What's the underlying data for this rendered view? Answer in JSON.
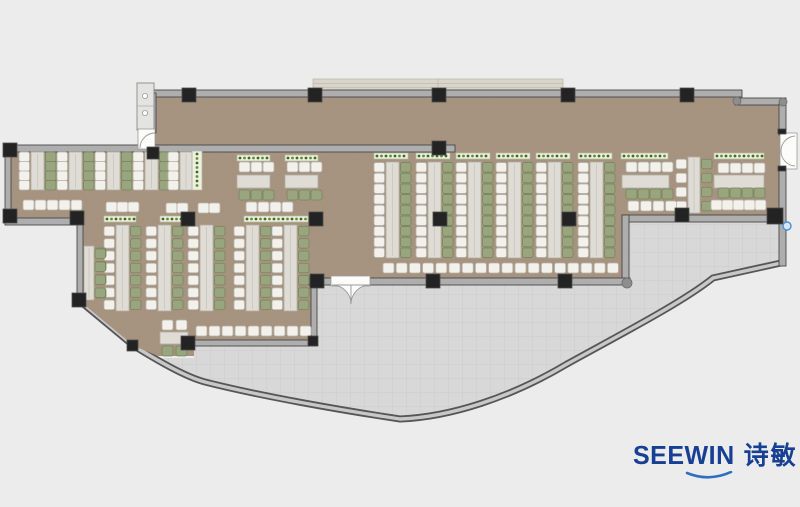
{
  "logo": {
    "wordmark": "SEEWIN",
    "chinese": "诗敏",
    "color": "#173f93",
    "swoosh_color": "#2d6fc0"
  },
  "plan": {
    "colors": {
      "bg": "#ececec",
      "floor": "#a89480",
      "grainTint": "#4a3c2c",
      "terrace": "#d8d8d8",
      "tileLine": "#c9c9c9",
      "wall": "#aeaeae",
      "wallEdge": "#474747",
      "wallDark": "#565656",
      "wallLight": "#c8c8c8",
      "column": "#232323",
      "columnEdge": "#4d4d4d",
      "desk": "#dfdcd5",
      "deskEdge": "#b1ada3",
      "chairW": "#f3f1ec",
      "chairWs": "#b9b5ac",
      "chairG": "#99a57e",
      "chairGs": "#77865c",
      "planter": "#edefe1",
      "planterEdge": "#b5bba2",
      "dotA": "#5f9030",
      "dotB": "#3f6b1f",
      "plank": "#d9d5ca",
      "plankLine": "#bcb8ad",
      "doorFill": "#fcfcfb",
      "doorLine": "#9a9a9a",
      "fixture": "#e3e3df",
      "node": "#8e8e8e",
      "blueNode": "#4a8fd4"
    },
    "floorPath": "M 153,95 L 740,95 L 740,104 L 783,104 L 783,218 L 625,218 L 625,281 L 314,281 L 314,343 L 194,343 L 194,356 L 158,356 L 134,346 L 81,302 L 81,222 L 8,222 L 8,149 L 150,149 L 150,95 Z",
    "terracePath": "M 314,284 L 625,284 L 625,221 L 783,221 L 783,262 L 713,278 C 683,302 625,332 567,364 C 510,398 450,417 400,419 C 340,410 260,396 205,382 C 186,377 160,362 137,349 L 158,358 L 194,358 L 194,345 L 314,345 Z",
    "curveWallPath": "M 81,302 L 134,346 C 160,362 186,377 205,382 C 260,396 340,410 400,419 C 450,417 510,398 567,364 C 625,332 683,302 713,278 L 781,263",
    "plank": [
      313,
      79,
      250,
      13
    ],
    "walls": [
      [
        153,
        90,
        589,
        7
      ],
      [
        735,
        98,
        51,
        7
      ],
      [
        779,
        104,
        7,
        31
      ],
      [
        779,
        167,
        7,
        99
      ],
      [
        622,
        215,
        160,
        7
      ],
      [
        622,
        215,
        7,
        70
      ],
      [
        309,
        278,
        24,
        7
      ],
      [
        368,
        278,
        262,
        7
      ],
      [
        311,
        284,
        6,
        62
      ],
      [
        190,
        340,
        127,
        6
      ],
      [
        5,
        145,
        450,
        7
      ],
      [
        5,
        145,
        6,
        74
      ],
      [
        5,
        218,
        72,
        7
      ],
      [
        77,
        218,
        6,
        84
      ],
      [
        150,
        93,
        6,
        40
      ]
    ],
    "columns": [
      [
        182,
        88
      ],
      [
        308,
        88
      ],
      [
        432,
        88
      ],
      [
        561,
        88
      ],
      [
        680,
        88
      ],
      [
        432,
        141
      ],
      [
        3,
        143
      ],
      [
        3,
        209
      ],
      [
        70,
        211
      ],
      [
        72,
        293
      ],
      [
        127,
        340,
        11,
        11
      ],
      [
        147,
        147,
        12,
        12
      ],
      [
        181,
        212
      ],
      [
        309,
        212
      ],
      [
        433,
        212
      ],
      [
        562,
        212
      ],
      [
        181,
        336
      ],
      [
        308,
        336,
        10,
        10
      ],
      [
        310,
        274
      ],
      [
        426,
        274
      ],
      [
        558,
        274
      ],
      [
        675,
        208
      ],
      [
        767,
        208,
        16,
        16
      ],
      [
        778,
        129,
        8,
        5
      ],
      [
        778,
        166,
        8,
        5
      ]
    ],
    "planters": [
      [
        192,
        151,
        10,
        39
      ],
      [
        104,
        216,
        32,
        6
      ],
      [
        160,
        216,
        30,
        6
      ],
      [
        244,
        216,
        64,
        6
      ],
      [
        374,
        153,
        34,
        6
      ],
      [
        416,
        153,
        34,
        6
      ],
      [
        456,
        153,
        34,
        6
      ],
      [
        496,
        153,
        34,
        6
      ],
      [
        536,
        153,
        34,
        6
      ],
      [
        578,
        153,
        34,
        6
      ],
      [
        621,
        153,
        47,
        6
      ],
      [
        714,
        153,
        50,
        6
      ],
      [
        237,
        155,
        33,
        6
      ],
      [
        285,
        155,
        33,
        6
      ]
    ],
    "vRuns": [
      {
        "x": 31,
        "y": 152,
        "h": 38,
        "n": 4,
        "l": "w",
        "r": "g"
      },
      {
        "x": 69,
        "y": 152,
        "h": 38,
        "n": 4,
        "l": "w",
        "r": "g"
      },
      {
        "x": 107,
        "y": 152,
        "h": 38,
        "n": 4,
        "l": "w",
        "r": "g"
      },
      {
        "x": 145,
        "y": 152,
        "h": 38,
        "n": 4,
        "l": "w",
        "r": "g"
      },
      {
        "x": 180,
        "y": 152,
        "h": 38,
        "n": 4,
        "l": "w",
        "r": null,
        "w": 12
      },
      {
        "x": 116,
        "y": 225,
        "h": 86,
        "n": 7,
        "l": "w",
        "r": "g"
      },
      {
        "x": 158,
        "y": 225,
        "h": 86,
        "n": 7,
        "l": "w",
        "r": "g"
      },
      {
        "x": 200,
        "y": 225,
        "h": 86,
        "n": 7,
        "l": "w",
        "r": "g"
      },
      {
        "x": 246,
        "y": 225,
        "h": 86,
        "n": 7,
        "l": "w",
        "r": "g"
      },
      {
        "x": 284,
        "y": 225,
        "h": 86,
        "n": 7,
        "l": "w",
        "r": "g"
      },
      {
        "x": 386,
        "y": 162,
        "h": 96,
        "n": 9,
        "l": "w",
        "r": "g"
      },
      {
        "x": 428,
        "y": 162,
        "h": 96,
        "n": 9,
        "l": "w",
        "r": "g"
      },
      {
        "x": 468,
        "y": 162,
        "h": 96,
        "n": 9,
        "l": "w",
        "r": "g"
      },
      {
        "x": 508,
        "y": 162,
        "h": 96,
        "n": 9,
        "l": "w",
        "r": "g"
      },
      {
        "x": 548,
        "y": 162,
        "h": 96,
        "n": 9,
        "l": "w",
        "r": "g"
      },
      {
        "x": 590,
        "y": 162,
        "h": 96,
        "n": 9,
        "l": "w",
        "r": "g"
      },
      {
        "x": 688,
        "y": 157,
        "h": 56,
        "n": 4,
        "l": "w",
        "r": "g",
        "w": 12
      },
      {
        "x": 84,
        "y": 246,
        "h": 54,
        "n": 4,
        "l": null,
        "r": "g",
        "w": 10
      }
    ],
    "desks": [
      [
        237,
        175,
        33,
        13
      ],
      [
        285,
        175,
        33,
        13
      ],
      [
        622,
        175,
        47,
        13
      ],
      [
        714,
        175,
        50,
        13
      ],
      [
        160,
        332,
        28,
        12
      ]
    ],
    "chairRows": [
      {
        "x": 23,
        "y": 200,
        "n": 5,
        "c": "w",
        "sp": 12
      },
      {
        "x": 106,
        "y": 202,
        "n": 3,
        "c": "w",
        "sp": 11
      },
      {
        "x": 166,
        "y": 203,
        "n": 2,
        "c": "w",
        "sp": 11
      },
      {
        "x": 198,
        "y": 203,
        "n": 2,
        "c": "w",
        "sp": 11
      },
      {
        "x": 246,
        "y": 202,
        "n": 4,
        "c": "w",
        "sp": 12
      },
      {
        "x": 239,
        "y": 162,
        "n": 3,
        "c": "w",
        "sp": 12
      },
      {
        "x": 287,
        "y": 162,
        "n": 3,
        "c": "w",
        "sp": 12
      },
      {
        "x": 239,
        "y": 190,
        "n": 3,
        "c": "g",
        "sp": 12
      },
      {
        "x": 287,
        "y": 190,
        "n": 3,
        "c": "g",
        "sp": 12
      },
      {
        "x": 626,
        "y": 162,
        "n": 4,
        "c": "w",
        "sp": 12
      },
      {
        "x": 718,
        "y": 163,
        "n": 4,
        "c": "w",
        "sp": 12
      },
      {
        "x": 626,
        "y": 189,
        "n": 4,
        "c": "g",
        "sp": 12
      },
      {
        "x": 718,
        "y": 188,
        "n": 4,
        "c": "g",
        "sp": 12
      },
      {
        "x": 628,
        "y": 201,
        "n": 4,
        "c": "w",
        "sp": 12.5
      },
      {
        "x": 711,
        "y": 200,
        "n": 5,
        "c": "w",
        "sp": 11
      },
      {
        "x": 196,
        "y": 326,
        "n": 9,
        "c": "w",
        "sp": 13
      },
      {
        "x": 383,
        "y": 263,
        "n": 18,
        "c": "w",
        "sp": 13.2
      },
      {
        "x": 162,
        "y": 320,
        "n": 2,
        "c": "w",
        "sp": 14
      },
      {
        "x": 162,
        "y": 346,
        "n": 2,
        "c": "g",
        "sp": 14
      },
      {
        "x": 95,
        "y": 249,
        "n": 4,
        "c": "g",
        "sp": 13,
        "dir": "v"
      }
    ],
    "fixture": [
      137,
      83,
      17,
      47
    ],
    "doors": [
      {
        "rect": [
          138,
          129,
          17,
          20
        ],
        "paths": [
          "M 140,148 A 15,15 0 0 1 155,133"
        ],
        "filled": false
      },
      {
        "rect": [
          331,
          276,
          39,
          10
        ],
        "paths": [
          "M 332,285 A 19,19 0 0 1 351,304 L 351,285 Z",
          "M 370,285 A 19,19 0 0 0 351,304 L 351,285 Z"
        ],
        "filled": true
      },
      {
        "rect": [
          780,
          133,
          17,
          36
        ],
        "paths": [
          "M 795,136 A 15,15 0 0 0 781,151",
          "M 795,166 A 15,15 0 0 1 781,151"
        ],
        "filled": false
      }
    ],
    "nodes": [
      [
        737,
        101,
        4
      ],
      [
        783,
        102,
        4
      ],
      [
        627,
        283,
        5
      ]
    ],
    "blueNode": [
      787,
      226,
      4
    ]
  }
}
